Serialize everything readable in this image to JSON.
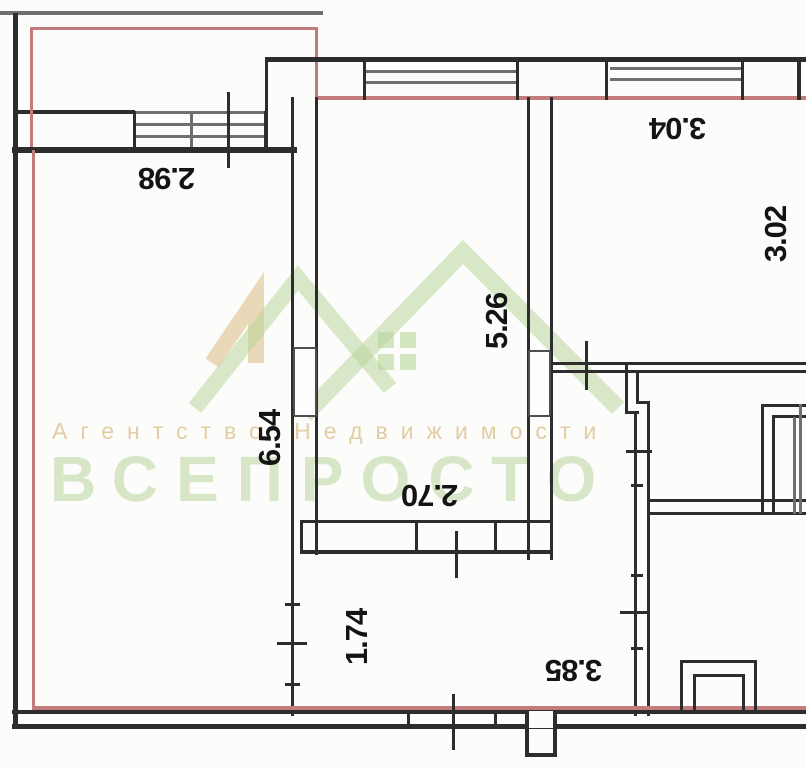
{
  "plan_title": "apartment-floor-plan",
  "dimensions": {
    "balcony_width": "2.98",
    "top_right_room_width": "3.04",
    "top_right_room_depth": "3.02",
    "living_room_depth": "6.54",
    "bedroom_depth": "5.26",
    "bedroom_width": "2.70",
    "hall_depth": "1.74",
    "kitchen_width": "3.85"
  },
  "watermark": {
    "line1": "Агентство Недвижимости",
    "line2": "ВСЕПРОСТО"
  },
  "colors": {
    "wall": "#2d2d2d",
    "window_line": "#6e6e6e",
    "apartment_boundary": "#c27c7c",
    "watermark_green": "#b9d69c",
    "watermark_tan": "#e3cda1"
  }
}
